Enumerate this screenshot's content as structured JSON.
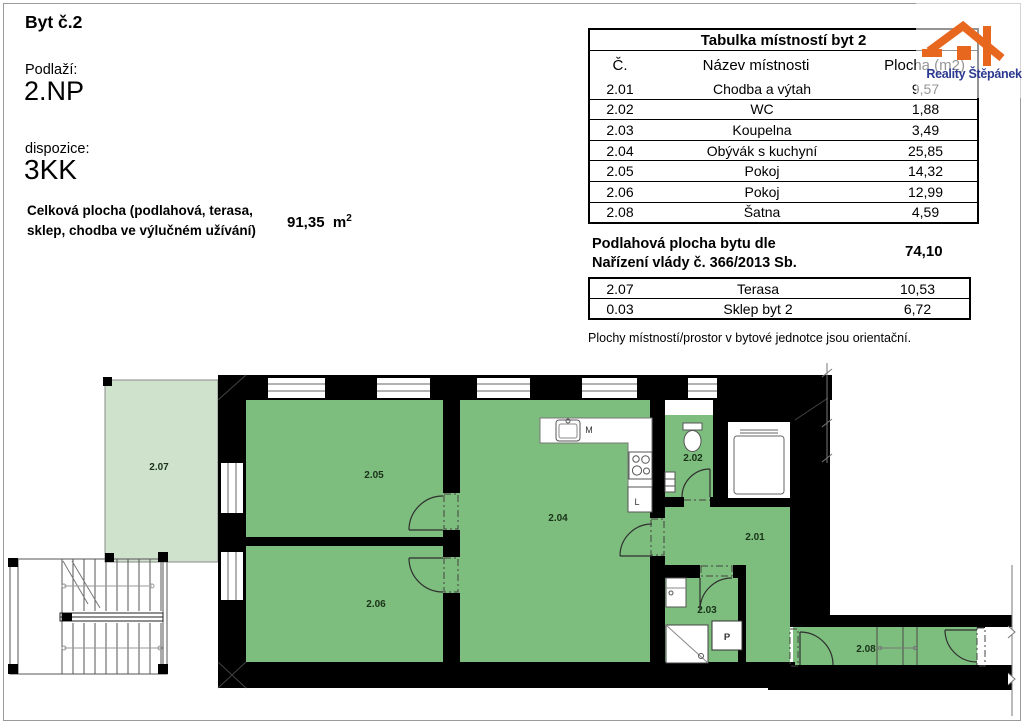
{
  "page": {
    "title": "Byt č.2",
    "floor_label": "Podlaží:",
    "floor_value": "2.NP",
    "layout_label": "dispozice:",
    "layout_value": "3KK",
    "total_area_label_line1": "Celková plocha (podlahová, terasa,",
    "total_area_label_line2": "sklep, chodba ve výlučném užívání)",
    "total_area_value": "91,35",
    "total_area_unit": "m",
    "total_area_unit_sup": "2"
  },
  "logo": {
    "brand": "Reality Štěpánek"
  },
  "room_table": {
    "title": "Tabulka místností byt 2",
    "col_no": "Č.",
    "col_name": "Název místnosti",
    "col_area": "Plocha (m2)",
    "rows": [
      {
        "no": "2.01",
        "name": "Chodba a výtah",
        "area": "9,57"
      },
      {
        "no": "2.02",
        "name": "WC",
        "area": "1,88"
      },
      {
        "no": "2.03",
        "name": "Koupelna",
        "area": "3,49"
      },
      {
        "no": "2.04",
        "name": "Obývák s kuchyní",
        "area": "25,85"
      },
      {
        "no": "2.05",
        "name": "Pokoj",
        "area": "14,32"
      },
      {
        "no": "2.06",
        "name": "Pokoj",
        "area": "12,99"
      },
      {
        "no": "2.08",
        "name": "Šatna",
        "area": "4,59"
      }
    ]
  },
  "floor_area": {
    "label_line1": "Podlahová plocha bytu dle",
    "label_line2": "Nařízení vlády č. 366/2013 Sb.",
    "value": "74,10"
  },
  "extra_table": {
    "rows": [
      {
        "no": "2.07",
        "name": "Terasa",
        "area": "10,53"
      },
      {
        "no": "0.03",
        "name": "Sklep byt 2",
        "area": "6,72"
      }
    ]
  },
  "disclaimer": "Plochy místností/prostor v bytové jednotce jsou orientační.",
  "plan": {
    "labels": {
      "r201": "2.01",
      "r202": "2.02",
      "r203": "2.03",
      "r204": "2.04",
      "r205": "2.05",
      "r206": "2.06",
      "r207": "2.07",
      "r208": "2.08"
    },
    "fixtures": {
      "m": "M",
      "l": "L",
      "p": "P"
    },
    "colors": {
      "room_green": "#7dbd7d",
      "terrace_green": "#cfe3cc",
      "wall_black": "#000000",
      "logo_orange": "#e8671f",
      "logo_navy": "#2b3990"
    }
  }
}
